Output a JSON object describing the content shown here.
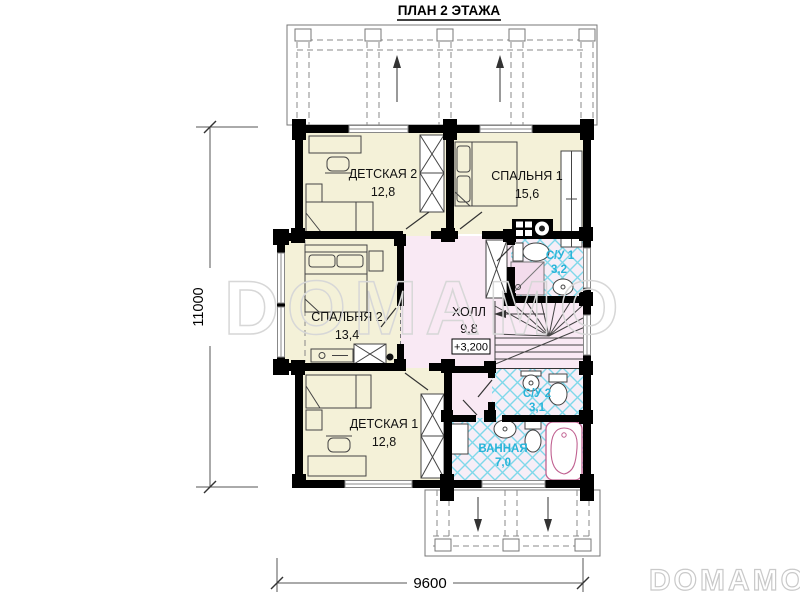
{
  "title": "ПЛАН 2 ЭТАЖА",
  "rooms": {
    "detskaya2": {
      "name": "ДЕТСКАЯ 2",
      "area": "12,8"
    },
    "spalnya1": {
      "name": "СПАЛЬНЯ 1",
      "area": "15,6"
    },
    "spalnya2": {
      "name": "СПАЛЬНЯ 2",
      "area": "13,4"
    },
    "detskaya1": {
      "name": "ДЕТСКАЯ 1",
      "area": "12,8"
    },
    "hall": {
      "name": "ХОЛЛ",
      "area": "9,8"
    },
    "su1": {
      "name": "С/У 1",
      "area": "3,2"
    },
    "su2": {
      "name": "С/У 2",
      "area": "3,1"
    },
    "vannaya": {
      "name": "ВАННАЯ",
      "area": "7,0"
    }
  },
  "elevation_mark": "+3,200",
  "dimensions": {
    "height": "11000",
    "width": "9600"
  },
  "watermarks": {
    "center": "DOMAMO",
    "corner": "DOMAMO"
  },
  "colors": {
    "room_fill": "#f4f1d8",
    "hall_fill": "#f9e9f4",
    "tile_bg": "#f6eef7",
    "tile_line": "#7fd8ea",
    "bath_label": "#29b4d9",
    "wall": "#000000"
  }
}
